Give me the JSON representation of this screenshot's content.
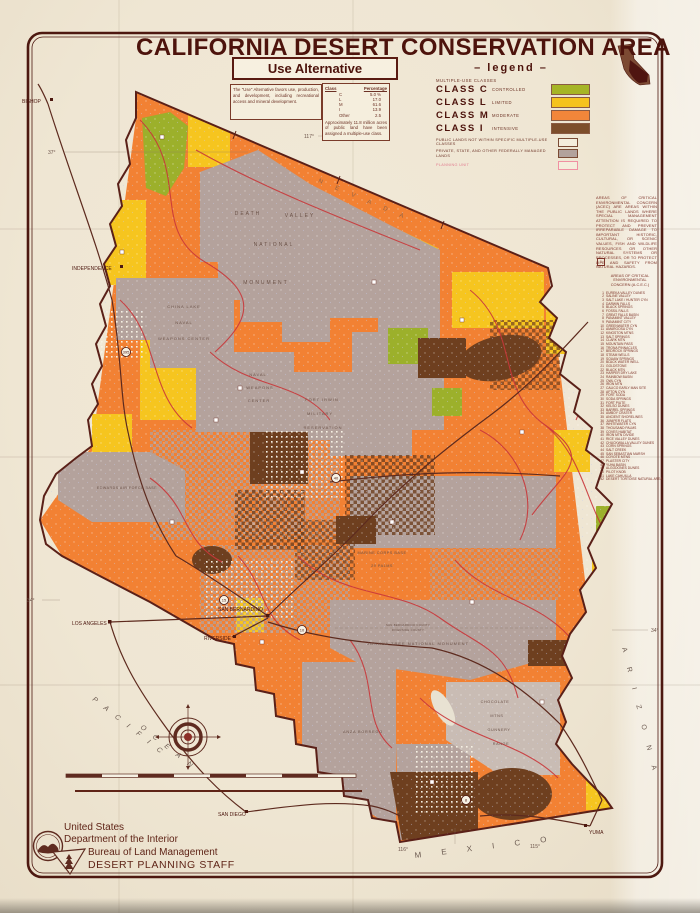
{
  "page": {
    "title": "CALIFORNIA DESERT CONSERVATION AREA",
    "subtitle": "Use Alternative",
    "description": "The \"Use\" Alternative favors use, production, and development, including recreational access and mineral development."
  },
  "class_table": {
    "headers": {
      "cls": "Class",
      "pct": "Percentage"
    },
    "rows": [
      {
        "cls": "C",
        "pct": "5.0 %"
      },
      {
        "cls": "L",
        "pct": "17.0"
      },
      {
        "cls": "M",
        "pct": "61.6"
      },
      {
        "cls": "I",
        "pct": "13.9"
      },
      {
        "cls": "Other",
        "pct": "2.5"
      }
    ],
    "note": "Approximately 11.8 million acres of public land have been assigned a multiple-use class."
  },
  "legend": {
    "title": "– legend –",
    "group": "MULTIPLE-USE CLASSES",
    "classes": [
      {
        "name": "CLASS C",
        "desc": "CONTROLLED",
        "color": "#a6b526"
      },
      {
        "name": "CLASS L",
        "desc": "LIMITED",
        "color": "#f5c31d"
      },
      {
        "name": "CLASS M",
        "desc": "MODERATE",
        "color": "#f2863a"
      },
      {
        "name": "CLASS I",
        "desc": "INTENSIVE",
        "color": "#7d4e2b"
      }
    ],
    "extras": [
      {
        "label": "PUBLIC LANDS NOT WITHIN SPECIFIC MULTIPLE-USE CLASSES",
        "color": "#f4eddc",
        "border": "#7a4a33",
        "text_color": "#6b3024"
      },
      {
        "label": "PRIVATE, STATE, AND OTHER FEDERALLY MANAGED LANDS",
        "color": "#b2a29c",
        "border": "#7a4a33",
        "text_color": "#6b3024"
      },
      {
        "label": "PLANNING UNIT",
        "color": "#f4eddc",
        "border": "#f090a2",
        "text_color": "#e27d90"
      }
    ]
  },
  "acec": {
    "intro": "AREAS OF CRITICAL ENVIRONMENTAL CONCERN (ACEC) ARE AREAS WITHIN THE PUBLIC LANDS WHERE SPECIAL MANAGEMENT ATTENTION IS REQUIRED TO PROTECT AND PREVENT IRREPARABLE DAMAGE TO IMPORTANT HISTORIC, CULTURAL, OR SCENIC VALUES, FISH AND WILDLIFE RESOURCES OR OTHER NATURAL SYSTEMS OR PROCESSES, OR TO PROTECT LIFE AND SAFETY FROM NATURAL HAZARDS.",
    "title": "AREAS OF CRITICAL ENVIRONMENTAL CONCERN (A.C.E.C.)",
    "box_symbol": "1",
    "items": [
      "EUREKA VALLEY DUNES",
      "SALINE VALLEY",
      "SALT LAKE / HUNTER CYN",
      "DARWIN FALLS",
      "BLACK SPRINGS",
      "FOSSIL FALLS",
      "GREAT FALLS BASIN",
      "PANAMINT VALLEY",
      "PANAMINT CITY",
      "GREENWATER CYN",
      "AMARGOSA CYN",
      "KINGSTON MTNS",
      "SALT SPRINGS",
      "CLARK MTN",
      "MOUNTAIN PASS",
      "TRONA PINNACLES",
      "BEDROCK SPRINGS",
      "STEAM WELLS",
      "SQUAW SPRINGS",
      "BLACK WATER WELL",
      "GOLDSTONE",
      "BLACK MTN",
      "HARPER DRY LAKE",
      "RAINBOW BASIN",
      "OWL CYN",
      "IRON MTN",
      "CALICO EARLY MAN SITE",
      "AFTON CYN",
      "FORT SODA",
      "SODA SPRINGS",
      "FORT PIUTE",
      "KELSO DUNES",
      "BARREL SPRINGS",
      "AMBOY CRATER",
      "ANCIENT SHORELINES",
      "JUNIPER FLATS",
      "WHITEWATER CYN",
      "THOUSAND PALMS",
      "COVES HABITAT",
      "IRON MTN DIVIDE",
      "RICE VALLEY DUNES",
      "CHUCKWALLA VALLEY DUNES",
      "CORN SPRINGS",
      "SALT CREEK",
      "SAN SEBASTIAN MARSH",
      "COYOTE MTNS",
      "PLASTER CITY",
      "YUHA BASIN",
      "ALGODONES DUNES",
      "PILOT KNOB",
      "LAKE CAHUILLA",
      "DESERT TORTOISE NATURAL AREA"
    ]
  },
  "imprint": {
    "l1": "United States",
    "l2": "Department of the Interior",
    "l3": "Bureau of Land Management",
    "l4": "DESERT PLANNING STAFF"
  },
  "map_labels": {
    "dv1": "DEATH",
    "dv2": "VALLEY",
    "dv3": "NATIONAL",
    "dv4": "MONUMENT",
    "cl1": "CHINA LAKE",
    "cl2": "NAVAL",
    "cl3": "WEAPONS CENTER",
    "nwc1": "NAVAL",
    "nwc2": "WEAPONS",
    "nwc3": "CENTER",
    "fi1": "FORT IRWIN",
    "fi2": "MILITARY",
    "fi3": "RESERVATION",
    "ed": "EDWARDS AIR FORCE BASE",
    "mc1": "MARINE CORPS BASE",
    "mc2": "29 PALMS",
    "jt": "JOSHUA TREE NATIONAL MONUMENT",
    "cm1": "CHOCOLATE",
    "cm2": "MTNS",
    "cm3": "GUNNERY",
    "cm4": "RANGE",
    "ab": "ANZA BORREGO",
    "cnty1": "SAN BERNARDINO COUNTY",
    "cnty2": "RIVERSIDE COUNTY",
    "bishop": "BISHOP",
    "independence": "INDEPENDENCE",
    "los_angeles": "LOS ANGELES",
    "san_bernardino": "SAN BERNARDINO",
    "riverside": "RIVERSIDE",
    "san_diego": "SAN DIEGO",
    "yuma": "YUMA",
    "pacific": "P A C I F I C",
    "ocean": "O C E A N",
    "mexico": "M  E  X  I  C  O",
    "arizona": "A R I Z O N A",
    "nevada": "N E V A D A",
    "lat37": "37°",
    "lat34w": "34°",
    "lat34e": "34°",
    "lon117": "117°",
    "lon116": "116°",
    "lon115": "115°",
    "sh15": "15",
    "sh40": "40",
    "sh10": "10",
    "sh395": "395",
    "sh8": "8"
  }
}
